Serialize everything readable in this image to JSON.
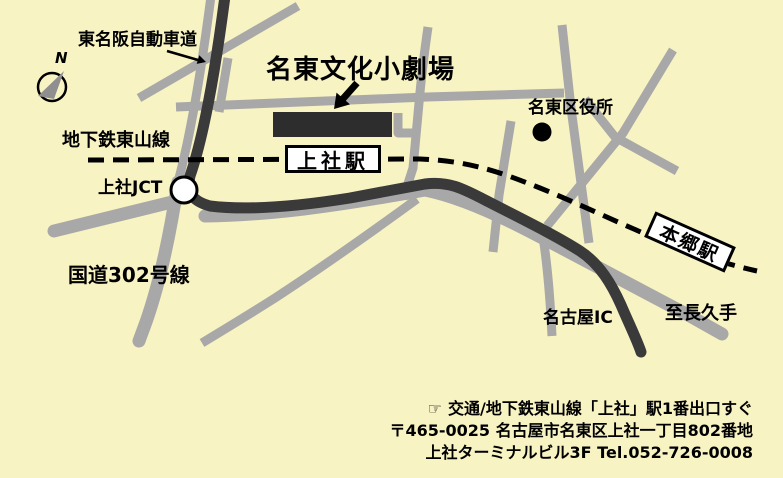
{
  "map": {
    "title": "名東文化小劇場",
    "labels": {
      "expressway": "東名阪自動車道",
      "subway_line": "地下鉄東山線",
      "junction": "上社JCT",
      "route_302": "国道302号線",
      "kamiyashiro_station": "上社駅",
      "hongo_station": "本郷駅",
      "ward_office": "名東区役所",
      "nagoya_ic": "名古屋IC",
      "to_nagakute": "至長久手",
      "compass_north": "N"
    },
    "footer": {
      "pointer_icon": "☞",
      "access": "交通/地下鉄東山線「上社」駅1番出口すぐ",
      "postal_address": "〒465-0025 名古屋市名東区上社一丁目802番地",
      "building_tel": "上社ターミナルビル3F Tel.052-726-0008"
    },
    "colors": {
      "background": "#F8F3C3",
      "road_gray": "#A8A8A8",
      "expressway_dark": "#3A3A3A",
      "theater_block": "#2D2D2D",
      "station_box_bg": "#FFFFFF",
      "ink": "#000000"
    }
  }
}
